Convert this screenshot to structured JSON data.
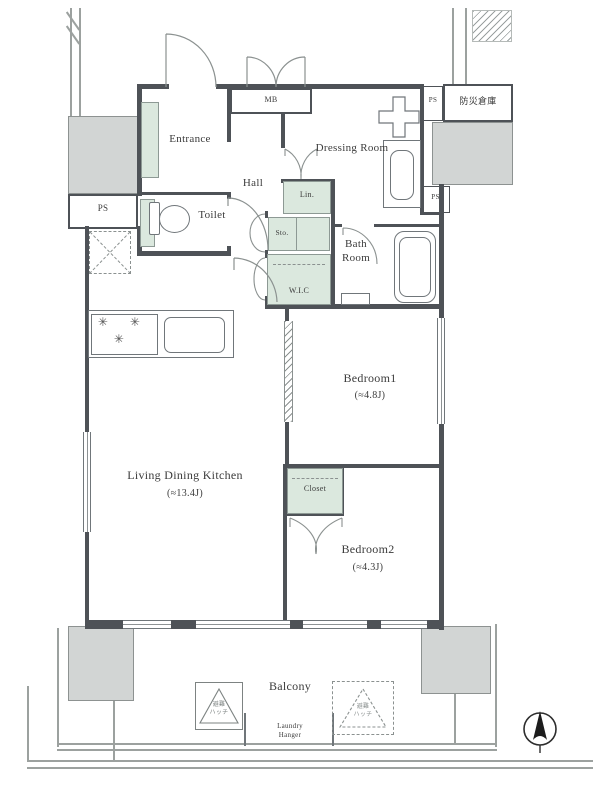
{
  "rooms": {
    "entrance": {
      "name": "Entrance"
    },
    "hall": {
      "name": "Hall"
    },
    "toilet": {
      "name": "Toilet"
    },
    "dressing": {
      "name": "Dressing Room"
    },
    "bath": {
      "name": "Bath Room"
    },
    "bedroom1": {
      "name": "Bedroom1",
      "size": "(≈4.8J)"
    },
    "bedroom2": {
      "name": "Bedroom2",
      "size": "(≈4.3J)"
    },
    "ldk": {
      "name": "Living Dining Kitchen",
      "size": "(≈13.4J)"
    },
    "balcony": {
      "name": "Balcony"
    }
  },
  "storage": {
    "linen": "Lin.",
    "sto": "Sto.",
    "wic": "W.I.C",
    "closet": "Closet"
  },
  "utilities": {
    "mb": "MB",
    "ps": "PS",
    "disaster_storage": "防災倉庫"
  },
  "balcony_items": {
    "laundry1": "Laundry",
    "laundry2": "Hanger",
    "hatch1": "避難",
    "hatch2": "ハッチ"
  },
  "colors": {
    "wall": "#4e5257",
    "pillar": "#d2d5d4",
    "cabinet": "#dbe8de",
    "thin_line": "#9ca19f"
  }
}
